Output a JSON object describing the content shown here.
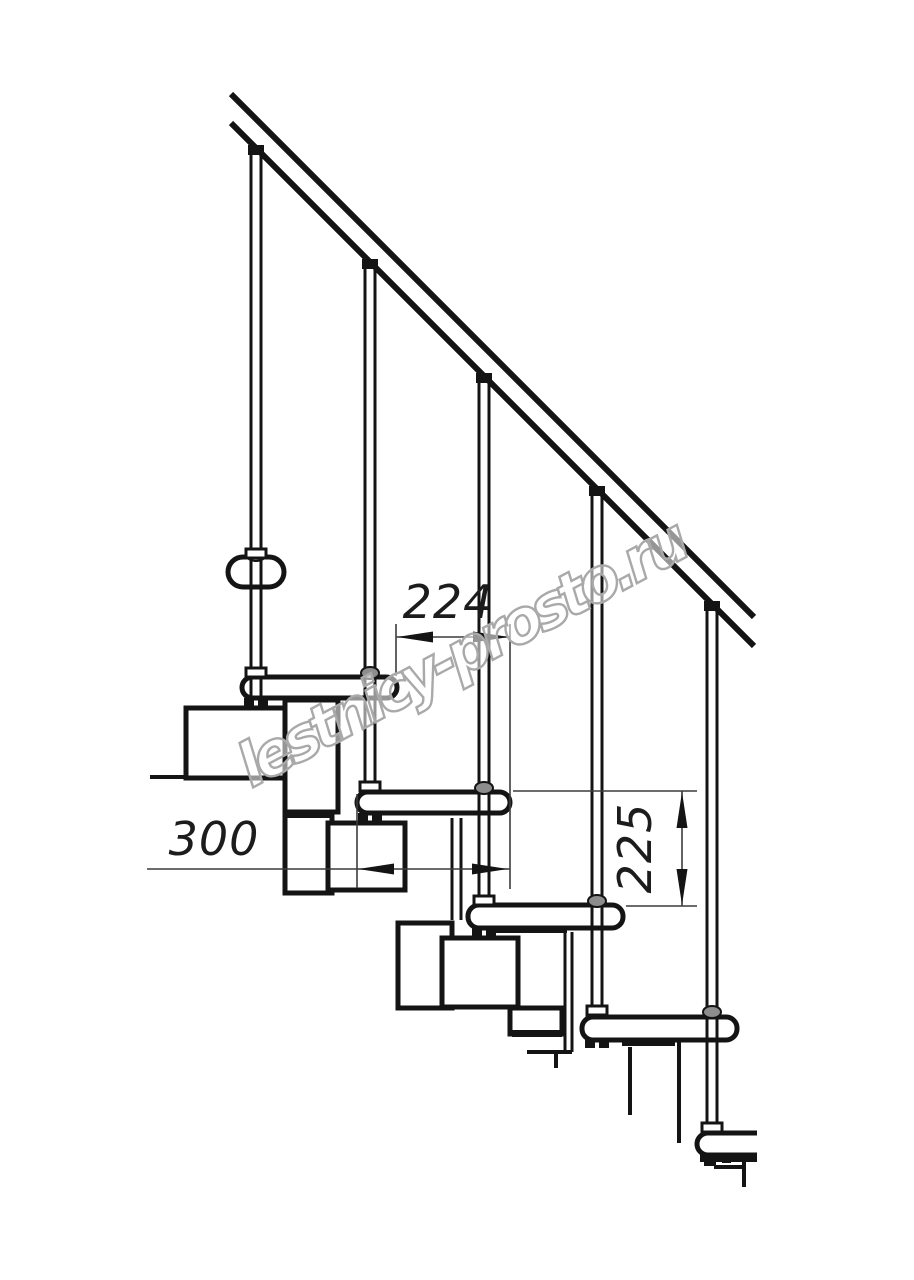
{
  "drawing": {
    "title": "modular-staircase-side-view",
    "dimensions": {
      "step_run": "224",
      "tread_depth": "300",
      "step_rise": "225"
    },
    "watermark": {
      "text": "lestnicy-prosto.ru"
    },
    "colors": {
      "line": "#141414",
      "dimension_line": "#3c3c3c",
      "watermark_stroke": "#a9a9a9",
      "background": "#ffffff"
    }
  }
}
